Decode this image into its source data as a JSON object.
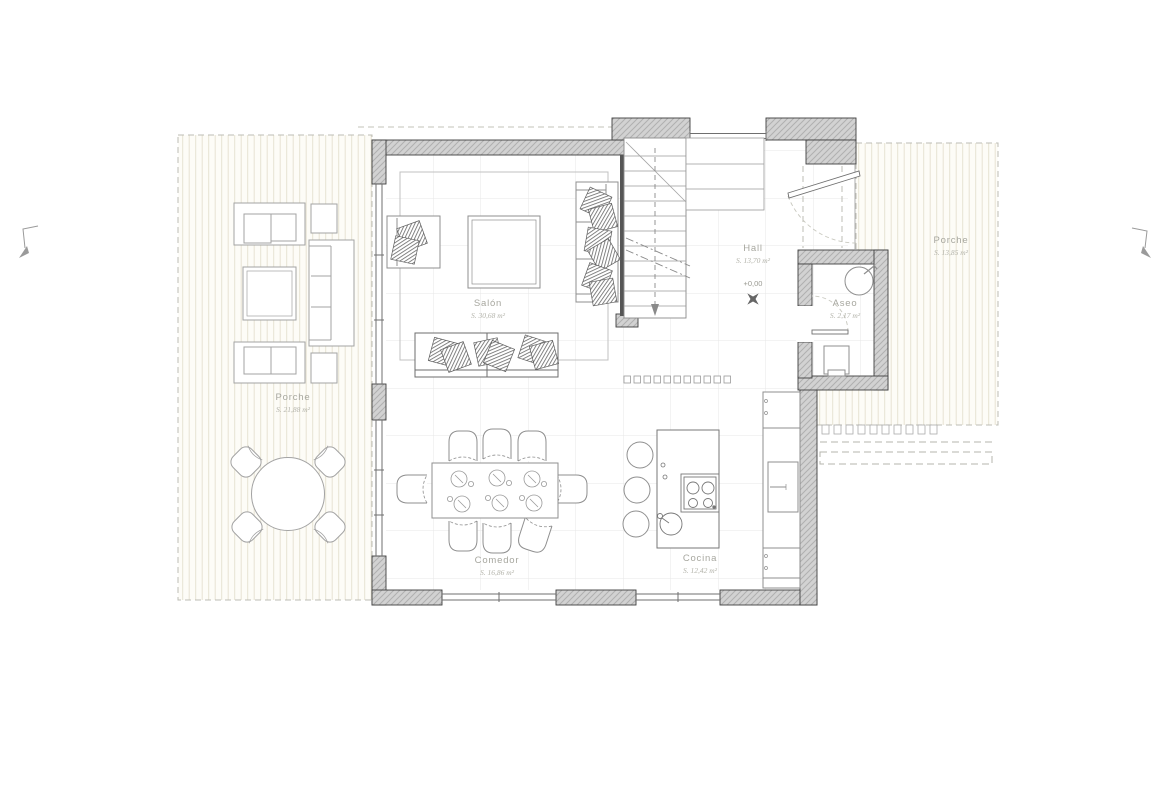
{
  "rooms": {
    "salon": {
      "name": "Salón",
      "area": "S. 30,68 m²"
    },
    "comedor": {
      "name": "Comedor",
      "area": "S. 16,86 m²"
    },
    "cocina": {
      "name": "Cocina",
      "area": "S. 12,42 m²"
    },
    "hall": {
      "name": "Hall",
      "area": "S. 13,70 m²",
      "level": "+0,00"
    },
    "aseo": {
      "name": "Aseo",
      "area": "S. 2,17 m²"
    },
    "porche_left": {
      "name": "Porche",
      "area": "S. 21,88 m²"
    },
    "porche_right": {
      "name": "Porche",
      "area": "S. 13,85 m²"
    }
  },
  "symbols": {
    "hall_level_marker": "four-point-star-level-icon",
    "entry_door": "door-swing-arc",
    "aseo_door": "door-swing-arc",
    "stair_direction": "down-arrow",
    "edge_marks": "corner-reference-arrow"
  },
  "colors": {
    "wall_fill": "#d2d2d2",
    "wall_hatch": "#b0b0b0",
    "wall_outline": "#3f3f3f",
    "deck_stripe": "#e7e3d3",
    "grid_line": "#e7e7e7",
    "furniture_line": "#8f8f8f",
    "porch_furniture_line": "#a3a3a3",
    "label_text": "#a7a79f",
    "cushion_hatch": "#666666"
  }
}
